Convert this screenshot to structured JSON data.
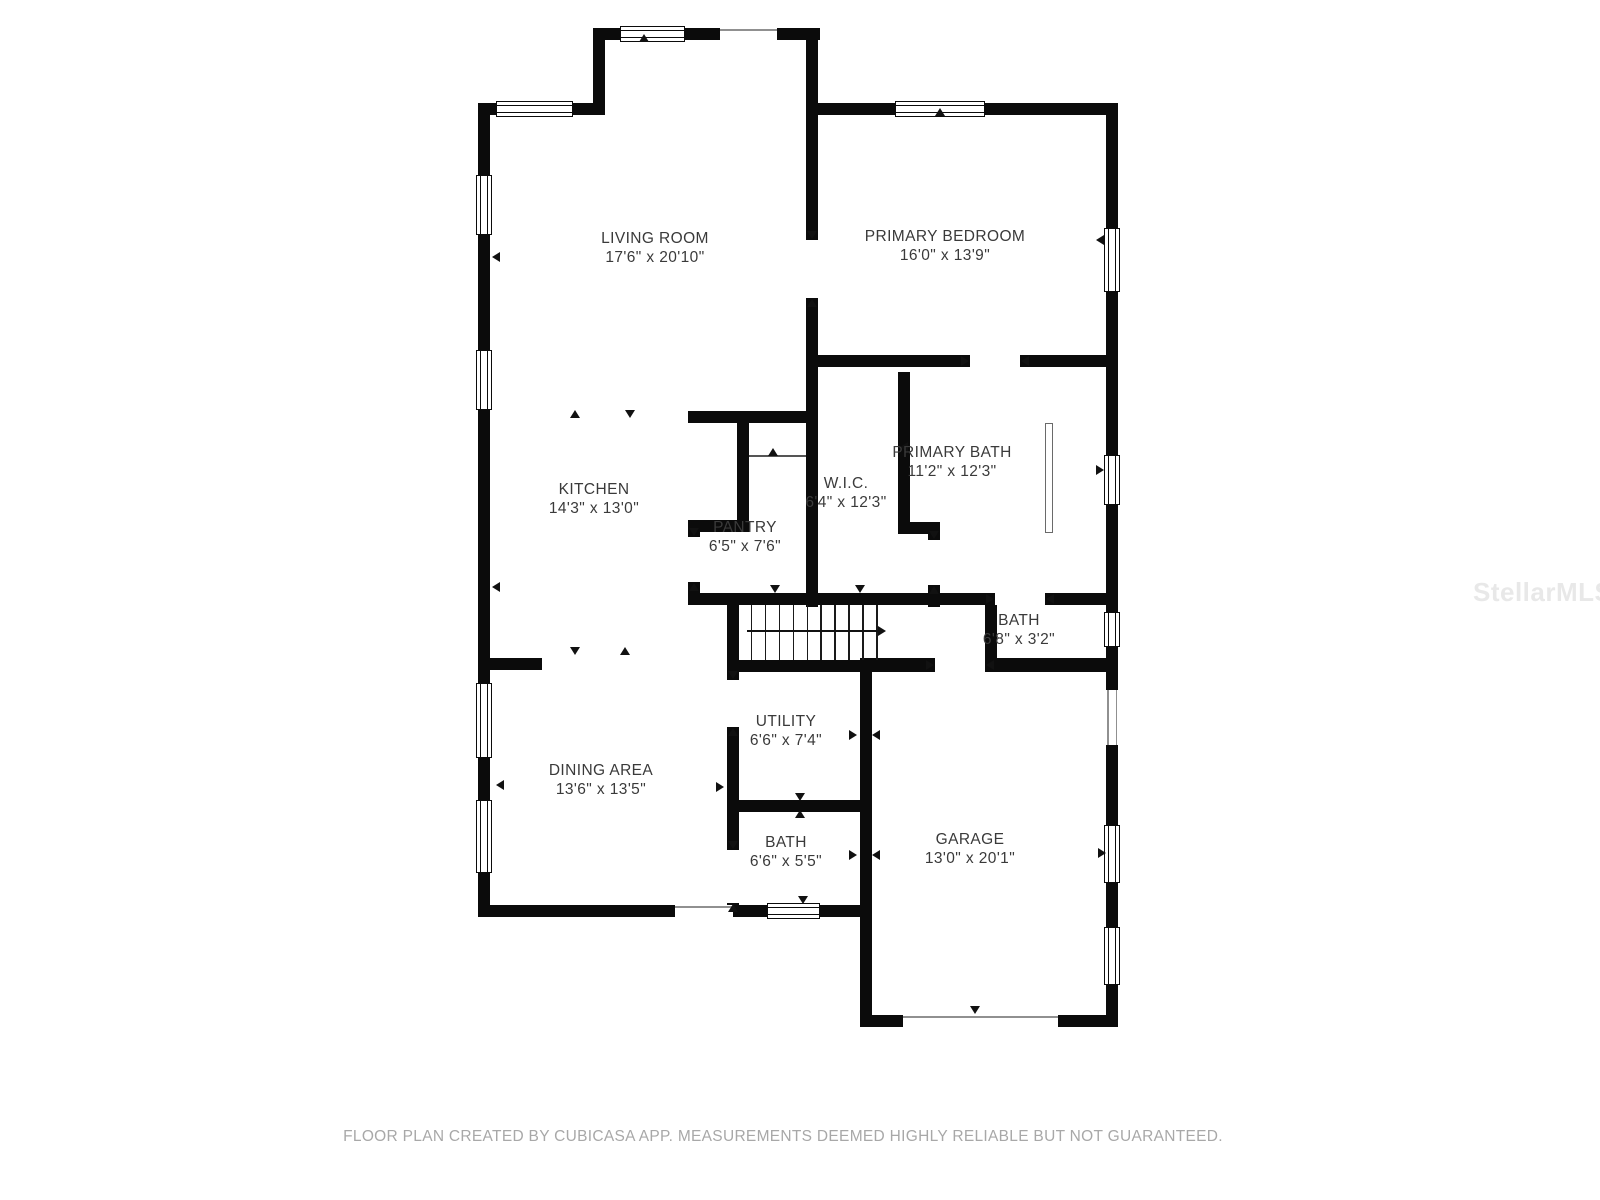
{
  "meta": {
    "footer": "FLOOR PLAN CREATED BY CUBICASA APP. MEASUREMENTS DEEMED HIGHLY RELIABLE BUT NOT GUARANTEED.",
    "watermark": "StellarMLS",
    "wall_color": "#0b0b0b",
    "label_color": "#3a3a3a"
  },
  "rooms": [
    {
      "id": "living-room",
      "name": "LIVING ROOM",
      "dims": "17'6\" x 20'10\"",
      "cx": 655,
      "cy": 248
    },
    {
      "id": "primary-bedroom",
      "name": "PRIMARY BEDROOM",
      "dims": "16'0\" x 13'9\"",
      "cx": 945,
      "cy": 246
    },
    {
      "id": "kitchen",
      "name": "KITCHEN",
      "dims": "14'3\" x 13'0\"",
      "cx": 594,
      "cy": 499
    },
    {
      "id": "pantry",
      "name": "PANTRY",
      "dims": "6'5\" x 7'6\"",
      "cx": 745,
      "cy": 537
    },
    {
      "id": "wic",
      "name": "W.I.C.",
      "dims": "6'4\" x 12'3\"",
      "cx": 846,
      "cy": 493
    },
    {
      "id": "primary-bath",
      "name": "PRIMARY BATH",
      "dims": "11'2\" x 12'3\"",
      "cx": 952,
      "cy": 462
    },
    {
      "id": "bath-upper",
      "name": "BATH",
      "dims": "6'8\" x 3'2\"",
      "cx": 1019,
      "cy": 630
    },
    {
      "id": "utility",
      "name": "UTILITY",
      "dims": "6'6\" x 7'4\"",
      "cx": 786,
      "cy": 731
    },
    {
      "id": "dining-area",
      "name": "DINING AREA",
      "dims": "13'6\" x 13'5\"",
      "cx": 601,
      "cy": 780
    },
    {
      "id": "bath-lower",
      "name": "BATH",
      "dims": "6'6\" x 5'5\"",
      "cx": 786,
      "cy": 852
    },
    {
      "id": "garage",
      "name": "GARAGE",
      "dims": "13'0\" x 20'1\"",
      "cx": 970,
      "cy": 849
    }
  ],
  "plan": {
    "walls": [
      [
        478,
        103,
        12,
        814
      ],
      [
        478,
        103,
        127,
        12
      ],
      [
        593,
        28,
        12,
        87
      ],
      [
        593,
        28,
        227,
        12
      ],
      [
        806,
        28,
        12,
        339
      ],
      [
        818,
        103,
        300,
        12
      ],
      [
        1106,
        103,
        12,
        924
      ],
      [
        818,
        355,
        300,
        12
      ],
      [
        806,
        367,
        12,
        240
      ],
      [
        898,
        372,
        12,
        150
      ],
      [
        898,
        522,
        42,
        12
      ],
      [
        928,
        534,
        12,
        73
      ],
      [
        688,
        593,
        430,
        12
      ],
      [
        688,
        411,
        130,
        12
      ],
      [
        737,
        423,
        12,
        99
      ],
      [
        688,
        520,
        61,
        12
      ],
      [
        688,
        532,
        12,
        73
      ],
      [
        478,
        658,
        64,
        12
      ],
      [
        727,
        593,
        12,
        79
      ],
      [
        727,
        660,
        145,
        12
      ],
      [
        727,
        672,
        12,
        245
      ],
      [
        727,
        800,
        145,
        12
      ],
      [
        860,
        658,
        12,
        369
      ],
      [
        872,
        658,
        246,
        14
      ],
      [
        478,
        905,
        394,
        12
      ],
      [
        860,
        1015,
        258,
        12
      ],
      [
        985,
        605,
        12,
        53
      ]
    ],
    "windows": [
      [
        496,
        101,
        77,
        16,
        "h"
      ],
      [
        620,
        26,
        65,
        16,
        "h"
      ],
      [
        895,
        101,
        90,
        16,
        "h"
      ],
      [
        1104,
        228,
        16,
        64,
        "v"
      ],
      [
        1104,
        455,
        16,
        50,
        "v"
      ],
      [
        1104,
        612,
        16,
        35,
        "v"
      ],
      [
        1104,
        825,
        16,
        58,
        "v"
      ],
      [
        1104,
        927,
        16,
        58,
        "v"
      ],
      [
        767,
        903,
        53,
        16,
        "h"
      ],
      [
        476,
        175,
        16,
        60,
        "v"
      ],
      [
        476,
        350,
        16,
        60,
        "v"
      ],
      [
        476,
        683,
        16,
        75,
        "v"
      ],
      [
        476,
        800,
        16,
        73,
        "v"
      ]
    ],
    "doors": [
      [
        806,
        240,
        12,
        58,
        "v"
      ],
      [
        970,
        355,
        50,
        12,
        "h"
      ],
      [
        928,
        540,
        12,
        45,
        "v"
      ],
      [
        995,
        593,
        50,
        12,
        "h"
      ],
      [
        935,
        658,
        50,
        14,
        "h"
      ],
      [
        727,
        680,
        12,
        47,
        "v"
      ],
      [
        727,
        850,
        12,
        53,
        "v"
      ],
      [
        688,
        537,
        12,
        45,
        "v"
      ]
    ],
    "openings": [
      [
        720,
        28,
        57,
        12,
        "h"
      ],
      [
        1106,
        690,
        12,
        55,
        "v"
      ],
      [
        675,
        905,
        58,
        12,
        "h"
      ],
      [
        903,
        1015,
        155,
        12,
        "h"
      ]
    ],
    "marks": [
      [
        644,
        38,
        "up"
      ],
      [
        940,
        112,
        "up"
      ],
      [
        575,
        414,
        "up"
      ],
      [
        630,
        414,
        "down"
      ],
      [
        575,
        651,
        "down"
      ],
      [
        625,
        651,
        "up"
      ],
      [
        775,
        589,
        "down"
      ],
      [
        860,
        589,
        "down"
      ],
      [
        904,
        447,
        "left"
      ],
      [
        1100,
        240,
        "left"
      ],
      [
        1100,
        470,
        "right"
      ],
      [
        1102,
        853,
        "right"
      ],
      [
        496,
        257,
        "left"
      ],
      [
        496,
        587,
        "left"
      ],
      [
        500,
        785,
        "left"
      ],
      [
        803,
        900,
        "down"
      ],
      [
        975,
        1010,
        "down"
      ],
      [
        853,
        735,
        "right"
      ],
      [
        876,
        735,
        "left"
      ],
      [
        853,
        855,
        "right"
      ],
      [
        876,
        855,
        "left"
      ],
      [
        800,
        797,
        "down"
      ],
      [
        800,
        814,
        "up"
      ],
      [
        720,
        787,
        "right"
      ],
      [
        773,
        452,
        "up"
      ]
    ],
    "stairs": {
      "x": 737,
      "y": 605,
      "w": 153,
      "h": 55,
      "risers": 10,
      "arrow_y": 25
    },
    "glass": [
      1045,
      423,
      8,
      110
    ],
    "pantry_line": [
      749,
      455,
      57,
      2
    ],
    "footer_pos": {
      "x": 783,
      "y": 1128
    },
    "watermark_pos": {
      "x": 1473,
      "y": 577
    }
  }
}
